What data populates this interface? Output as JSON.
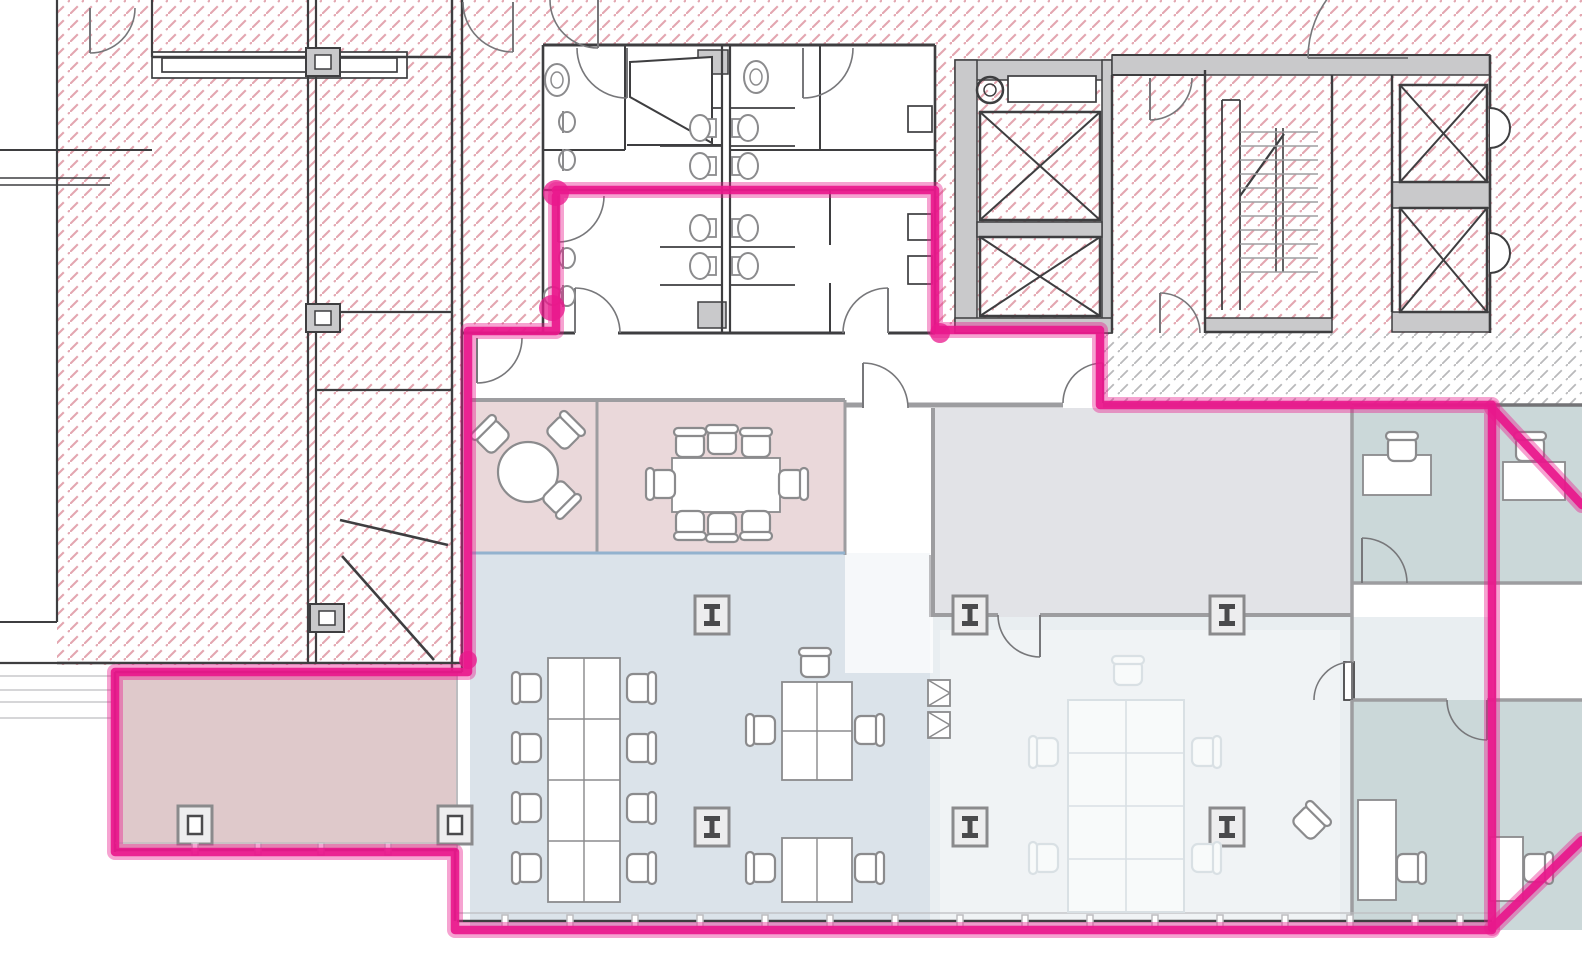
{
  "canvas": {
    "width": 1582,
    "height": 980
  },
  "palette": {
    "wall": "#3e3e40",
    "dark2": "#737376",
    "mid": "#9d9da0",
    "lite": "#bdbdc0",
    "blue": "#93b2ce",
    "furn": "#8b8b8d",
    "grayFill": "#c9c9cb",
    "hatchPink": "#e3a6b0",
    "hatchGray": "#b9b9bb",
    "zonePink": "#ead8da",
    "zonePinkDark": "#dfc9cb",
    "zoneBlue": "#dbe3ea",
    "zoneBlueLight": "#e9eef1",
    "zoneGray": "#e2e3e7",
    "zoneTeal": "#cbd8d9",
    "ghost": "#d9e0e4",
    "ghostFill": "#f8fafa",
    "highlight": "#e9188c",
    "paper": "#ffffff"
  },
  "zones": [
    {
      "name": "meeting-rooms-pink",
      "x": 470,
      "y": 398,
      "w": 375,
      "h": 157,
      "f": "zonePink"
    },
    {
      "name": "open-office-blue",
      "x": 470,
      "y": 553,
      "w": 460,
      "h": 377,
      "f": "zoneBlue"
    },
    {
      "name": "storage-room-gray",
      "x": 933,
      "y": 408,
      "w": 419,
      "h": 209,
      "f": "zoneGray"
    },
    {
      "name": "open-area-light",
      "x": 930,
      "y": 617,
      "w": 562,
      "h": 313,
      "f": "zoneBlueLight"
    },
    {
      "name": "teal-office-1",
      "x": 1352,
      "y": 405,
      "w": 143,
      "h": 178,
      "f": "zoneTeal"
    },
    {
      "name": "teal-office-2",
      "x": 1495,
      "y": 405,
      "w": 87,
      "h": 178,
      "f": "zoneTeal"
    },
    {
      "name": "teal-office-3",
      "x": 1352,
      "y": 700,
      "w": 143,
      "h": 230,
      "f": "zoneTeal"
    },
    {
      "name": "teal-office-4",
      "x": 1495,
      "y": 700,
      "w": 87,
      "h": 230,
      "f": "zoneTeal"
    },
    {
      "name": "corner-room-pink",
      "x": 115,
      "y": 672,
      "w": 342,
      "h": 178,
      "f": "zonePinkDark"
    },
    {
      "name": "white-strip",
      "x": 845,
      "y": 403,
      "w": 88,
      "h": 270,
      "f": "#ffffff",
      "op": 0.75
    },
    {
      "name": "washout",
      "x": 940,
      "y": 630,
      "w": 400,
      "h": 295,
      "f": "#ffffff",
      "op": 0.32
    }
  ],
  "hatches": [
    {
      "x": 57,
      "y": 0,
      "w": 405,
      "h": 665,
      "t": "p"
    },
    {
      "x": 462,
      "y": 0,
      "w": 498,
      "h": 45,
      "t": "p"
    },
    {
      "x": 462,
      "y": 45,
      "w": 81,
      "h": 288,
      "t": "p"
    },
    {
      "x": 935,
      "y": 0,
      "w": 647,
      "h": 55,
      "t": "p"
    },
    {
      "x": 935,
      "y": 55,
      "w": 555,
      "h": 278,
      "t": "p"
    },
    {
      "x": 1490,
      "y": 0,
      "w": 92,
      "h": 333,
      "t": "p"
    },
    {
      "x": 1100,
      "y": 333,
      "w": 482,
      "h": 72,
      "t": "g"
    }
  ],
  "grayRects": [
    [
      955,
      60,
      157,
      20
    ],
    [
      955,
      60,
      22,
      273
    ],
    [
      1102,
      60,
      10,
      273
    ],
    [
      977,
      222,
      125,
      15
    ],
    [
      955,
      318,
      157,
      15
    ],
    [
      1112,
      55,
      378,
      20
    ],
    [
      1205,
      318,
      127,
      14
    ],
    [
      1392,
      182,
      98,
      26
    ],
    [
      1392,
      312,
      98,
      20
    ],
    [
      698,
      50,
      30,
      24
    ],
    [
      698,
      302,
      28,
      26
    ]
  ],
  "outlineRects": [
    [
      152,
      52,
      255,
      26
    ],
    [
      162,
      58,
      235,
      14
    ],
    [
      1008,
      76,
      88,
      26
    ],
    [
      1344,
      662,
      10,
      38
    ],
    [
      908,
      106,
      24,
      26
    ],
    [
      908,
      214,
      24,
      26
    ],
    [
      908,
      256,
      24,
      28
    ]
  ],
  "walls": [
    [
      57,
      0,
      57,
      622,
      2.2,
      "wall"
    ],
    [
      0,
      622,
      57,
      622,
      2,
      "wall"
    ],
    [
      0,
      150,
      152,
      150,
      2,
      "wall"
    ],
    [
      0,
      178,
      110,
      178,
      1.5,
      "wall"
    ],
    [
      0,
      185,
      110,
      185,
      1.5,
      "wall"
    ],
    [
      152,
      0,
      152,
      57,
      2.2,
      "wall"
    ],
    [
      152,
      57,
      452,
      57,
      2.5,
      "wall"
    ],
    [
      308,
      0,
      308,
      663,
      2.2,
      "wall"
    ],
    [
      316,
      0,
      316,
      663,
      2.2,
      "wall"
    ],
    [
      452,
      0,
      452,
      672,
      2.4,
      "wall"
    ],
    [
      462,
      0,
      462,
      672,
      2.4,
      "wall"
    ],
    [
      57,
      663,
      462,
      663,
      2.4,
      "wall"
    ],
    [
      316,
      312,
      452,
      312,
      2.2,
      "wall"
    ],
    [
      316,
      390,
      452,
      390,
      2.2,
      "wall"
    ],
    [
      340,
      520,
      448,
      545,
      2.6,
      "wall"
    ],
    [
      342,
      556,
      434,
      660,
      2.6,
      "wall"
    ],
    [
      543,
      45,
      935,
      45,
      3,
      "wall"
    ],
    [
      543,
      45,
      543,
      333,
      2.6,
      "wall"
    ],
    [
      935,
      45,
      935,
      190,
      2.6,
      "wall"
    ],
    [
      935,
      190,
      935,
      333,
      2.4,
      "wall"
    ],
    [
      462,
      333,
      575,
      333,
      3,
      "wall"
    ],
    [
      618,
      333,
      845,
      333,
      3,
      "wall"
    ],
    [
      888,
      333,
      935,
      333,
      3,
      "wall"
    ],
    [
      543,
      190,
      935,
      190,
      2.2,
      "wall"
    ],
    [
      625,
      45,
      625,
      150,
      2,
      "wall"
    ],
    [
      543,
      150,
      625,
      150,
      2,
      "wall"
    ],
    [
      627,
      145,
      722,
      145,
      2,
      "wall"
    ],
    [
      730,
      150,
      935,
      150,
      2,
      "wall"
    ],
    [
      820,
      45,
      820,
      150,
      2,
      "wall"
    ],
    [
      722,
      45,
      722,
      333,
      2.2,
      "wall"
    ],
    [
      730,
      45,
      730,
      333,
      2.2,
      "wall"
    ],
    [
      660,
      108,
      722,
      108,
      1.8,
      "wall"
    ],
    [
      730,
      108,
      795,
      108,
      1.8,
      "wall"
    ],
    [
      660,
      146,
      722,
      146,
      1.8,
      "wall"
    ],
    [
      730,
      146,
      795,
      146,
      1.8,
      "wall"
    ],
    [
      660,
      247,
      722,
      247,
      1.8,
      "wall"
    ],
    [
      730,
      247,
      795,
      247,
      1.8,
      "wall"
    ],
    [
      660,
      285,
      722,
      285,
      1.8,
      "wall"
    ],
    [
      730,
      285,
      795,
      285,
      1.8,
      "wall"
    ],
    [
      830,
      190,
      830,
      245,
      2,
      "wall"
    ],
    [
      830,
      283,
      830,
      333,
      2,
      "wall"
    ],
    [
      1112,
      75,
      1112,
      333,
      2.4,
      "wall"
    ],
    [
      1205,
      70,
      1205,
      333,
      2.4,
      "wall"
    ],
    [
      1112,
      55,
      1490,
      55,
      2,
      "wall"
    ],
    [
      1112,
      75,
      1205,
      75,
      2,
      "wall"
    ],
    [
      1332,
      75,
      1332,
      318,
      2.4,
      "wall"
    ],
    [
      1392,
      75,
      1392,
      312,
      2.4,
      "wall"
    ],
    [
      1490,
      55,
      1490,
      333,
      2.6,
      "wall"
    ],
    [
      1205,
      332,
      1332,
      332,
      2.4,
      "wall"
    ],
    [
      1222,
      100,
      1222,
      310,
      1.8,
      "wall"
    ],
    [
      1240,
      100,
      1240,
      310,
      1.8,
      "wall"
    ],
    [
      1222,
      100,
      1240,
      100,
      1.8,
      "wall"
    ],
    [
      1276,
      128,
      1276,
      272,
      1.6,
      "wall"
    ],
    [
      1283,
      128,
      1283,
      272,
      1.6,
      "wall"
    ],
    [
      1240,
      196,
      1284,
      134,
      2.2,
      "wall"
    ],
    [
      470,
      400,
      845,
      400,
      4,
      "mid"
    ],
    [
      845,
      405,
      863,
      405,
      5,
      "mid"
    ],
    [
      908,
      405,
      1063,
      405,
      5,
      "mid"
    ],
    [
      1103,
      405,
      1352,
      405,
      5,
      "mid"
    ],
    [
      1352,
      405,
      1582,
      405,
      3.5,
      "dark2"
    ],
    [
      597,
      400,
      597,
      553,
      3,
      "mid"
    ],
    [
      845,
      400,
      845,
      555,
      3,
      "mid"
    ],
    [
      470,
      553,
      845,
      553,
      3,
      "blue"
    ],
    [
      933,
      408,
      933,
      617,
      4,
      "mid"
    ],
    [
      933,
      615,
      998,
      615,
      4,
      "mid"
    ],
    [
      1040,
      615,
      1352,
      615,
      4,
      "mid"
    ],
    [
      1352,
      405,
      1352,
      663,
      3.5,
      "mid"
    ],
    [
      1352,
      700,
      1352,
      930,
      3.5,
      "mid"
    ],
    [
      1352,
      583,
      1582,
      583,
      3.5,
      "mid"
    ],
    [
      1352,
      700,
      1447,
      700,
      3.5,
      "mid"
    ],
    [
      1487,
      700,
      1582,
      700,
      3.5,
      "mid"
    ],
    [
      1495,
      405,
      1495,
      930,
      2,
      "mid"
    ],
    [
      930,
      555,
      930,
      617,
      2,
      "lite"
    ],
    [
      457,
      672,
      457,
      852,
      2,
      "lite"
    ],
    [
      115,
      672,
      462,
      672,
      2.5,
      "wall"
    ],
    [
      115,
      672,
      115,
      852,
      2.5,
      "wall"
    ],
    [
      115,
      850,
      457,
      850,
      2.5,
      "wall"
    ],
    [
      115,
      843,
      457,
      843,
      1.2,
      "lite"
    ],
    [
      455,
      850,
      455,
      921,
      2.5,
      "wall"
    ],
    [
      457,
      921,
      1492,
      921,
      2.5,
      "wall"
    ],
    [
      457,
      913,
      1492,
      913,
      1.2,
      "lite"
    ],
    [
      0,
      663,
      115,
      663,
      2.2,
      "wall"
    ],
    [
      0,
      676,
      112,
      676,
      1.2,
      "lite"
    ],
    [
      0,
      690,
      112,
      690,
      1.2,
      "lite"
    ],
    [
      0,
      702,
      112,
      702,
      1.2,
      "lite"
    ],
    [
      0,
      718,
      112,
      718,
      1.2,
      "lite"
    ]
  ],
  "stairTreads": {
    "x1": 1240,
    "x2": 1318,
    "y0": 132,
    "step": 14,
    "count": 11
  },
  "xboxes": [
    [
      980,
      112,
      120,
      108
    ],
    [
      980,
      237,
      120,
      79
    ],
    [
      1400,
      85,
      87,
      97
    ],
    [
      1400,
      208,
      87,
      104
    ]
  ],
  "leftColumns": [
    [
      306,
      48
    ],
    [
      306,
      304
    ],
    [
      310,
      604
    ]
  ],
  "columns": {
    "ibeam": [
      [
        712,
        615
      ],
      [
        712,
        827
      ],
      [
        970,
        615
      ],
      [
        970,
        827
      ],
      [
        1227,
        615
      ],
      [
        1227,
        827
      ]
    ],
    "square": [
      [
        195,
        825
      ],
      [
        455,
        825
      ]
    ]
  },
  "doors": [
    [
      863,
      408,
      45,
      -90,
      0,
      1
    ],
    [
      1103,
      403,
      40,
      -90,
      180,
      0
    ],
    [
      477,
      338,
      45,
      90,
      0,
      0
    ],
    [
      1040,
      615,
      42,
      90,
      180,
      1
    ],
    [
      1362,
      583,
      45,
      -90,
      0,
      1
    ],
    [
      1352,
      700,
      38,
      -90,
      180,
      0
    ],
    [
      1487,
      700,
      40,
      90,
      180,
      1
    ],
    [
      627,
      48,
      50,
      90,
      180,
      1
    ],
    [
      803,
      48,
      50,
      90,
      0,
      0
    ],
    [
      598,
      0,
      48,
      90,
      180,
      1
    ],
    [
      558,
      196,
      46,
      90,
      0,
      0
    ],
    [
      575,
      333,
      45,
      -90,
      0,
      1
    ],
    [
      888,
      333,
      45,
      -90,
      180,
      0
    ],
    [
      1150,
      78,
      42,
      90,
      0,
      0
    ],
    [
      1160,
      333,
      40,
      -90,
      0,
      1
    ],
    [
      1408,
      58,
      100,
      180,
      -90,
      1
    ],
    [
      90,
      8,
      45,
      90,
      0,
      0
    ],
    [
      513,
      2,
      50,
      90,
      180,
      1
    ]
  ],
  "paths": [
    {
      "d": "M1490,108 A20 20 0 0 1 1490,148",
      "f": "#ffffff",
      "s": "wall",
      "w": 2
    },
    {
      "d": "M1490,233 A20 20 0 0 1 1490,273",
      "f": "#ffffff",
      "s": "wall",
      "w": 2
    },
    {
      "d": "M630,62 L712,57 L712,143 L630,97 Z",
      "f": "#ffffff",
      "s": "wall",
      "w": 2
    }
  ],
  "tables": [
    {
      "x": 672,
      "y": 458,
      "w": 108,
      "h": 54,
      "cols": 0,
      "rows": 0
    },
    {
      "x": 548,
      "y": 658,
      "w": 72,
      "h": 244,
      "cols": 2,
      "rows": 4
    },
    {
      "x": 782,
      "y": 682,
      "w": 70,
      "h": 98,
      "cols": 2,
      "rows": 2
    },
    {
      "x": 782,
      "y": 838,
      "w": 70,
      "h": 64,
      "cols": 2,
      "rows": 1
    },
    {
      "x": 1363,
      "y": 455,
      "w": 68,
      "h": 40,
      "cols": 0,
      "rows": 0
    },
    {
      "x": 1503,
      "y": 462,
      "w": 62,
      "h": 38,
      "cols": 0,
      "rows": 0
    },
    {
      "x": 1358,
      "y": 800,
      "w": 38,
      "h": 100,
      "cols": 0,
      "rows": 0
    },
    {
      "x": 1490,
      "y": 837,
      "w": 33,
      "h": 64,
      "cols": 0,
      "rows": 0
    },
    {
      "x": 1068,
      "y": 700,
      "w": 116,
      "h": 212,
      "cols": 2,
      "rows": 4,
      "ghost": true
    }
  ],
  "roundTables": [
    [
      528,
      472,
      30
    ]
  ],
  "chairs": [
    [
      492,
      436,
      -45
    ],
    [
      564,
      432,
      45
    ],
    [
      560,
      498,
      135
    ],
    [
      690,
      444,
      0
    ],
    [
      722,
      441,
      0
    ],
    [
      756,
      444,
      0
    ],
    [
      690,
      524,
      180
    ],
    [
      722,
      526,
      180
    ],
    [
      756,
      524,
      180
    ],
    [
      662,
      484,
      -90
    ],
    [
      792,
      484,
      90
    ],
    [
      528,
      688,
      -90
    ],
    [
      528,
      748,
      -90
    ],
    [
      528,
      808,
      -90
    ],
    [
      528,
      868,
      -90
    ],
    [
      640,
      688,
      90
    ],
    [
      640,
      748,
      90
    ],
    [
      640,
      808,
      90
    ],
    [
      640,
      868,
      90
    ],
    [
      815,
      664,
      0
    ],
    [
      762,
      730,
      -90
    ],
    [
      868,
      730,
      90
    ],
    [
      762,
      868,
      -90
    ],
    [
      868,
      868,
      90
    ],
    [
      1402,
      448,
      0
    ],
    [
      1530,
      448,
      0
    ],
    [
      1410,
      868,
      90
    ],
    [
      1537,
      868,
      90
    ],
    [
      1310,
      822,
      45
    ]
  ],
  "ghostChairs": [
    [
      1045,
      752,
      -90
    ],
    [
      1045,
      858,
      -90
    ],
    [
      1205,
      752,
      90
    ],
    [
      1205,
      858,
      90
    ],
    [
      1128,
      672,
      0
    ]
  ],
  "toilets": [
    [
      700,
      128,
      1
    ],
    [
      748,
      128,
      -1
    ],
    [
      700,
      166,
      1
    ],
    [
      748,
      166,
      -1
    ],
    [
      700,
      228,
      1
    ],
    [
      748,
      228,
      -1
    ],
    [
      700,
      266,
      1
    ],
    [
      748,
      266,
      -1
    ]
  ],
  "sinksD": [
    [
      566,
      122
    ],
    [
      566,
      160
    ],
    [
      566,
      258
    ],
    [
      566,
      296
    ]
  ],
  "ovalSinks": [
    [
      557,
      80
    ],
    [
      756,
      77
    ]
  ],
  "circles": [
    {
      "cx": 990,
      "cy": 90,
      "r": 13,
      "w": 2.5,
      "c": "wall"
    },
    {
      "cx": 990,
      "cy": 90,
      "r": 6,
      "w": 1.5,
      "c": "wall"
    },
    {
      "cx": 553,
      "cy": 296,
      "r": 9,
      "w": 2,
      "c": "furn"
    }
  ],
  "mullionsBottom": {
    "y": 915,
    "xs": [
      505,
      570,
      635,
      700,
      765,
      830,
      895,
      960,
      1025,
      1090,
      1155,
      1220,
      1285,
      1350,
      1415,
      1460
    ]
  },
  "mullionsPinkRoom": {
    "y": 843,
    "xs": [
      195,
      258,
      321,
      388
    ]
  },
  "triBoxes": [
    [
      928,
      680
    ],
    [
      928,
      712
    ]
  ],
  "highlight": {
    "path": [
      [
        556,
        190
      ],
      [
        935,
        190
      ],
      [
        935,
        330
      ],
      [
        1100,
        330
      ],
      [
        1100,
        405
      ],
      [
        1492,
        405
      ],
      [
        1492,
        930
      ],
      [
        455,
        930
      ],
      [
        455,
        852
      ],
      [
        115,
        852
      ],
      [
        115,
        672
      ],
      [
        468,
        672
      ],
      [
        468,
        331
      ],
      [
        556,
        331
      ],
      [
        556,
        196
      ]
    ],
    "diagonals": [
      [
        1492,
        408,
        1582,
        505
      ],
      [
        1492,
        928,
        1582,
        840
      ]
    ],
    "dots": [
      [
        556,
        193,
        13
      ],
      [
        552,
        308,
        13
      ],
      [
        468,
        660,
        9
      ],
      [
        940,
        333,
        10
      ]
    ],
    "glowWidth": 16,
    "coreWidth": 8.5
  }
}
